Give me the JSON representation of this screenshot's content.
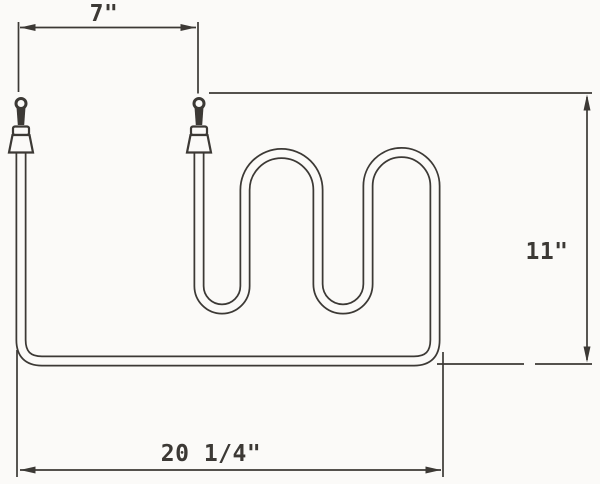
{
  "drawing": {
    "subject": "serpentine-heating-element-outline-drawing",
    "colors": {
      "ink": "#3c3935",
      "paper": "#fbfaf8"
    },
    "icons": {
      "dimension_arrowheads": "filled-triangle",
      "terminal_top": "eyelet-loop-with-bushing"
    },
    "dimensions": {
      "terminal_spacing": {
        "label": "7\"",
        "inches": 7
      },
      "overall_height": {
        "label": "11\"",
        "inches": 11
      },
      "overall_width": {
        "label": "20 1/4\"",
        "inches": 20.25
      }
    }
  }
}
